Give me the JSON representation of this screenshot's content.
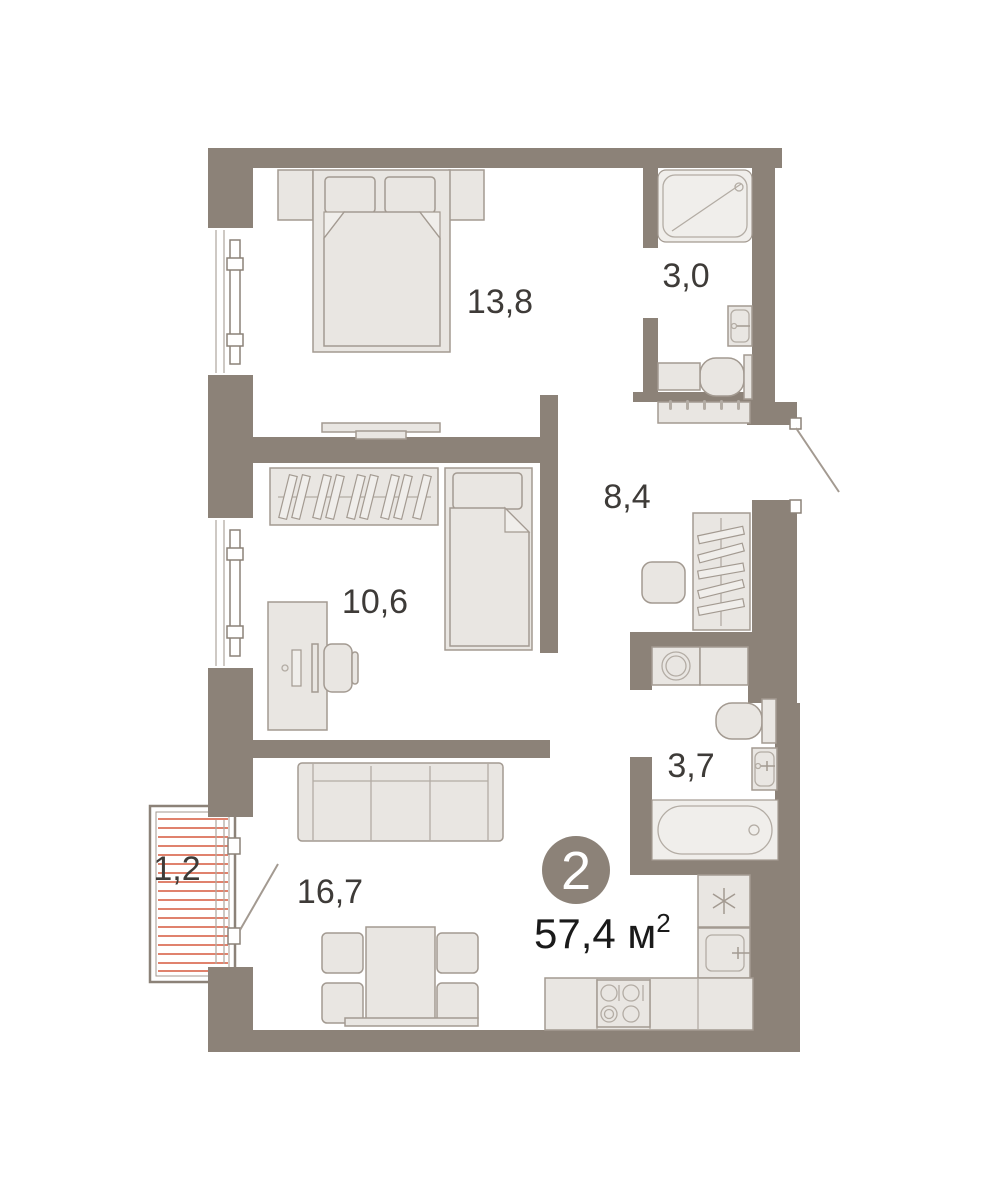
{
  "plan": {
    "title": "apartment-floor-plan",
    "badge": {
      "rooms_count": "2"
    },
    "total_area": {
      "main": "57,4 м",
      "sup": "2"
    },
    "rooms": [
      {
        "id": "bedroom",
        "label": "13,8"
      },
      {
        "id": "shower-room",
        "label": "3,0"
      },
      {
        "id": "hallway",
        "label": "8,4"
      },
      {
        "id": "second-room",
        "label": "10,6"
      },
      {
        "id": "bathroom",
        "label": "3,7"
      },
      {
        "id": "living-kitchen",
        "label": "16,7"
      },
      {
        "id": "balcony",
        "label": "1,2"
      }
    ],
    "colors": {
      "wall": "#8c8278",
      "furniture_fill": "#e9e6e2",
      "furniture_stroke": "#a39a91",
      "balcony_hatch": "#e0826d",
      "label_text": "#3e3b38",
      "badge_bg": "#8c8278",
      "badge_text": "#ffffff"
    }
  }
}
